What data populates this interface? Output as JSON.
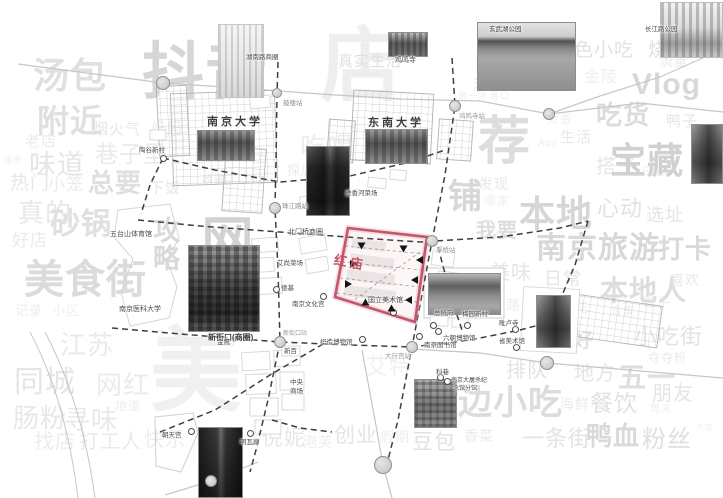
{
  "map": {
    "colors": {
      "zone": "#c4556a",
      "road": "#c6c6c6",
      "dashed": "#3f3f3f"
    },
    "zone": {
      "label": "红庙",
      "points": "348,228 427,237 415,322 335,297",
      "label_x": 334,
      "label_y": 252
    },
    "stations": [
      {
        "x": 163,
        "y": 83,
        "r": 7
      },
      {
        "x": 277,
        "y": 93,
        "r": 5
      },
      {
        "x": 455,
        "y": 106,
        "r": 6
      },
      {
        "x": 549,
        "y": 114,
        "r": 6
      },
      {
        "x": 275,
        "y": 208,
        "r": 6
      },
      {
        "x": 432,
        "y": 241,
        "r": 6
      },
      {
        "x": 280,
        "y": 342,
        "r": 6
      },
      {
        "x": 412,
        "y": 347,
        "r": 6
      },
      {
        "x": 547,
        "y": 363,
        "r": 7
      },
      {
        "x": 383,
        "y": 465,
        "r": 9
      },
      {
        "x": 211,
        "y": 481,
        "r": 6
      }
    ],
    "pois": [
      {
        "x": 163,
        "y": 158
      },
      {
        "x": 276,
        "y": 289
      },
      {
        "x": 323,
        "y": 296
      },
      {
        "x": 393,
        "y": 312
      },
      {
        "x": 433,
        "y": 325
      },
      {
        "x": 467,
        "y": 325
      },
      {
        "x": 515,
        "y": 329
      },
      {
        "x": 438,
        "y": 331
      },
      {
        "x": 419,
        "y": 336
      },
      {
        "x": 362,
        "y": 339
      },
      {
        "x": 516,
        "y": 347
      },
      {
        "x": 440,
        "y": 377
      },
      {
        "x": 447,
        "y": 381
      },
      {
        "x": 191,
        "y": 431
      },
      {
        "x": 250,
        "y": 433
      }
    ],
    "arrows": [
      {
        "x": 362,
        "y": 246,
        "a": 90
      },
      {
        "x": 404,
        "y": 249,
        "a": 90
      },
      {
        "x": 354,
        "y": 264,
        "a": 0
      },
      {
        "x": 349,
        "y": 284,
        "a": 0
      },
      {
        "x": 420,
        "y": 260,
        "a": 180
      },
      {
        "x": 415,
        "y": 280,
        "a": 180
      },
      {
        "x": 409,
        "y": 300,
        "a": 180
      },
      {
        "x": 366,
        "y": 302,
        "a": 270
      },
      {
        "x": 392,
        "y": 308,
        "a": 270
      }
    ],
    "photos": [
      {
        "x": 218,
        "y": 24,
        "w": 46,
        "h": 74,
        "v": "sketch",
        "name": "zifeng-tower-sketch"
      },
      {
        "x": 388,
        "y": 32,
        "w": 40,
        "h": 25,
        "v": "temple",
        "name": "jiming-temple-photo"
      },
      {
        "x": 477,
        "y": 22,
        "w": 99,
        "h": 69,
        "v": "lake",
        "name": "xuanwu-lake-photo"
      },
      {
        "x": 660,
        "y": 2,
        "w": 63,
        "h": 56,
        "v": "sketchcity",
        "name": "park-skyline-sketch"
      },
      {
        "x": 197,
        "y": 130,
        "w": 58,
        "h": 31,
        "v": "campus",
        "name": "nanjing-university-photo"
      },
      {
        "x": 365,
        "y": 129,
        "w": 63,
        "h": 35,
        "v": "campus",
        "name": "southeast-university-photo"
      },
      {
        "x": 306,
        "y": 146,
        "w": 44,
        "h": 70,
        "v": "tower",
        "name": "skyscraper-photo"
      },
      {
        "x": 188,
        "y": 245,
        "w": 72,
        "h": 87,
        "v": "city",
        "name": "xinjiekou-photo"
      },
      {
        "x": 428,
        "y": 273,
        "w": 73,
        "h": 42,
        "v": "gate",
        "name": "presidential-palace-photo"
      },
      {
        "x": 536,
        "y": 295,
        "w": 35,
        "h": 53,
        "v": "pagoda",
        "name": "pilu-temple-photo"
      },
      {
        "x": 414,
        "y": 379,
        "w": 43,
        "h": 49,
        "v": "building",
        "name": "kexiang-photo"
      },
      {
        "x": 198,
        "y": 427,
        "w": 45,
        "h": 71,
        "v": "street",
        "name": "old-street-photo"
      },
      {
        "x": 691,
        "y": 124,
        "w": 32,
        "h": 60,
        "v": "pagoda",
        "name": "east-temple-photo"
      }
    ],
    "labels": [
      {
        "t": "湖南路商圈",
        "x": 246,
        "y": 54,
        "s": 6.5
      },
      {
        "t": "鼓楼站",
        "x": 283,
        "y": 100,
        "s": 6.5,
        "c": "#8f8f8f"
      },
      {
        "t": "玄武湖公园",
        "x": 489,
        "y": 26,
        "s": 6.5,
        "c": "#3f3f3f"
      },
      {
        "t": "长江路公园",
        "x": 645,
        "y": 26,
        "s": 6.5
      },
      {
        "t": "鸡鸣寺",
        "x": 395,
        "y": 57,
        "s": 7
      },
      {
        "t": "鸡鸣寺站",
        "x": 459,
        "y": 113,
        "s": 6.5,
        "c": "#9a9a9a"
      },
      {
        "t": "南京大学",
        "x": 207,
        "y": 116,
        "s": 11,
        "b": 1,
        "ls": 3,
        "c": "#3c3c3c"
      },
      {
        "t": "东南大学",
        "x": 368,
        "y": 117,
        "s": 11,
        "b": 1,
        "ls": 3,
        "c": "#3c3c3c"
      },
      {
        "t": "陶谷新村",
        "x": 139,
        "y": 147,
        "s": 6.5
      },
      {
        "t": "珠江路站",
        "x": 282,
        "y": 203,
        "s": 6.5,
        "c": "#8f8f8f"
      },
      {
        "t": "进香河菜场",
        "x": 345,
        "y": 190,
        "s": 6.5
      },
      {
        "t": "北门桥商圈",
        "x": 288,
        "y": 229,
        "s": 7
      },
      {
        "t": "浮桥站",
        "x": 436,
        "y": 247,
        "s": 6.5,
        "c": "#9a9a9a"
      },
      {
        "t": "艾尚菜场",
        "x": 277,
        "y": 260,
        "s": 6.5
      },
      {
        "t": "德基",
        "x": 281,
        "y": 285,
        "s": 6.5
      },
      {
        "t": "南京文化宫",
        "x": 292,
        "y": 301,
        "s": 6.5
      },
      {
        "t": "国立美术馆",
        "x": 368,
        "y": 297,
        "s": 7
      },
      {
        "t": "五台山体育馆",
        "x": 110,
        "y": 231,
        "s": 7
      },
      {
        "t": "南京医科大学",
        "x": 119,
        "y": 306,
        "s": 7
      },
      {
        "t": "新街口(商圈)",
        "x": 208,
        "y": 333,
        "s": 8,
        "b": 1,
        "c": "#3c3c3c"
      },
      {
        "t": "新街口站",
        "x": 283,
        "y": 331,
        "s": 6,
        "c": "#9a9a9a"
      },
      {
        "t": "新百",
        "x": 284,
        "y": 348,
        "s": 6.5
      },
      {
        "t": "中央",
        "x": 290,
        "y": 379,
        "s": 6.5
      },
      {
        "t": "商场",
        "x": 290,
        "y": 388,
        "s": 6.5
      },
      {
        "t": "金鹰",
        "x": 217,
        "y": 339,
        "s": 6.5
      },
      {
        "t": "明瓦廊",
        "x": 240,
        "y": 439,
        "s": 6.5
      },
      {
        "t": "朝天宫",
        "x": 162,
        "y": 432,
        "s": 6.5
      },
      {
        "t": "织造博物馆",
        "x": 320,
        "y": 339,
        "s": 6.5
      },
      {
        "t": "大行宫站",
        "x": 385,
        "y": 353,
        "s": 6.5,
        "c": "#9a9a9a"
      },
      {
        "t": "南京图书馆",
        "x": 424,
        "y": 342,
        "s": 6.5
      },
      {
        "t": "六朝博物馆",
        "x": 443,
        "y": 335,
        "s": 6.5
      },
      {
        "t": "梅园新村",
        "x": 462,
        "y": 311,
        "s": 6.5
      },
      {
        "t": "总统府",
        "x": 434,
        "y": 310,
        "s": 6.5
      },
      {
        "t": "毗卢寺",
        "x": 499,
        "y": 320,
        "s": 6.5
      },
      {
        "t": "省美术馆",
        "x": 499,
        "y": 338,
        "s": 6.5
      },
      {
        "t": "科巷",
        "x": 436,
        "y": 369,
        "s": 6.5
      },
      {
        "t": "南京大屠杀纪",
        "x": 451,
        "y": 378,
        "s": 6
      },
      {
        "t": "念馆分馆",
        "x": 453,
        "y": 386,
        "s": 6
      }
    ],
    "wordcloud": [
      {
        "t": "汤包",
        "x": 33,
        "y": 58,
        "s": 36,
        "b": 1,
        "c": "#e0e0e0"
      },
      {
        "t": "抖音",
        "x": 142,
        "y": 42,
        "s": 62,
        "b": 1,
        "c": "#d6d6d6"
      },
      {
        "t": "店",
        "x": 320,
        "y": 26,
        "s": 82,
        "b": 1,
        "c": "#eeeeee"
      },
      {
        "t": "真实生活",
        "x": 338,
        "y": 54,
        "s": 15,
        "c": "#dfdfdf"
      },
      {
        "t": "吃喝",
        "x": 300,
        "y": 134,
        "s": 26,
        "c": "#ececec"
      },
      {
        "t": "探店",
        "x": 287,
        "y": 164,
        "s": 13,
        "c": "#ebebeb"
      },
      {
        "t": "收藏",
        "x": 202,
        "y": 175,
        "s": 11,
        "c": "#e9e9e9"
      },
      {
        "t": "下饭",
        "x": 149,
        "y": 181,
        "s": 15,
        "c": "#e5e5e5"
      },
      {
        "t": "妈妈",
        "x": 151,
        "y": 121,
        "s": 15,
        "c": "#ededed"
      },
      {
        "t": "烟火气",
        "x": 93,
        "y": 122,
        "s": 15,
        "c": "#e7e7e7"
      },
      {
        "t": "附近",
        "x": 37,
        "y": 105,
        "s": 32,
        "b": 1,
        "c": "#e0e0e0"
      },
      {
        "t": "老店",
        "x": 25,
        "y": 134,
        "s": 15,
        "c": "#eaeaea"
      },
      {
        "t": "城市",
        "x": 3,
        "y": 156,
        "s": 9,
        "c": "#eeeeee"
      },
      {
        "t": "味道",
        "x": 29,
        "y": 152,
        "s": 27,
        "c": "#e5e5e5"
      },
      {
        "t": "巷子里",
        "x": 95,
        "y": 143,
        "s": 23,
        "c": "#eaeaea"
      },
      {
        "t": "热门",
        "x": 10,
        "y": 174,
        "s": 19,
        "c": "#e7e7e7"
      },
      {
        "t": "小笼",
        "x": 48,
        "y": 176,
        "s": 17,
        "c": "#ebebeb"
      },
      {
        "t": "总要",
        "x": 88,
        "y": 170,
        "s": 26,
        "b": 1,
        "c": "#dfdfdf"
      },
      {
        "t": "真的",
        "x": 18,
        "y": 200,
        "s": 26,
        "c": "#e8e8e8"
      },
      {
        "t": "砂锅",
        "x": 50,
        "y": 210,
        "s": 30,
        "b": 1,
        "c": "#e0e0e0"
      },
      {
        "t": "好店",
        "x": 12,
        "y": 232,
        "s": 17,
        "c": "#ebebeb"
      },
      {
        "t": "攻略",
        "x": 150,
        "y": 216,
        "s": 27,
        "b": 1,
        "c": "#d9d9d9",
        "v": 1
      },
      {
        "t": "美食街",
        "x": 24,
        "y": 260,
        "s": 40,
        "b": 1,
        "c": "#dbdbdb"
      },
      {
        "t": "记录",
        "x": 15,
        "y": 304,
        "s": 13,
        "c": "#ececec"
      },
      {
        "t": "小区",
        "x": 52,
        "y": 304,
        "s": 13,
        "c": "#efefef"
      },
      {
        "t": "网红",
        "x": 196,
        "y": 213,
        "s": 52,
        "b": 1,
        "c": "#d2d2d2",
        "v": 1
      },
      {
        "t": "美",
        "x": 150,
        "y": 326,
        "s": 92,
        "b": 1,
        "c": "#f0f0f0"
      },
      {
        "t": "江苏",
        "x": 60,
        "y": 332,
        "s": 26,
        "c": "#eaeaea"
      },
      {
        "t": "同城",
        "x": 14,
        "y": 368,
        "s": 30,
        "c": "#e5e5e5"
      },
      {
        "t": "网红",
        "x": 96,
        "y": 372,
        "s": 26,
        "c": "#ebebeb"
      },
      {
        "t": "地道",
        "x": 115,
        "y": 400,
        "s": 12,
        "c": "#eeeeee"
      },
      {
        "t": "肠粉",
        "x": 13,
        "y": 405,
        "s": 26,
        "c": "#e7e7e7"
      },
      {
        "t": "寻味",
        "x": 64,
        "y": 407,
        "s": 26,
        "c": "#e9e9e9"
      },
      {
        "t": "找店",
        "x": 34,
        "y": 432,
        "s": 20,
        "c": "#ececec"
      },
      {
        "t": "打工人",
        "x": 79,
        "y": 432,
        "s": 20,
        "c": "#eaeaea"
      },
      {
        "t": "快乐",
        "x": 144,
        "y": 430,
        "s": 20,
        "c": "#ececec"
      },
      {
        "t": "倪妮",
        "x": 262,
        "y": 428,
        "s": 21,
        "c": "#e6e6e6"
      },
      {
        "t": "泡芙",
        "x": 303,
        "y": 435,
        "s": 14,
        "c": "#ededed"
      },
      {
        "t": "创业",
        "x": 334,
        "y": 425,
        "s": 21,
        "c": "#e4e4e4"
      },
      {
        "t": "假期",
        "x": 380,
        "y": 430,
        "s": 14,
        "c": "#eeeeee"
      },
      {
        "t": "艾特",
        "x": 366,
        "y": 356,
        "s": 22,
        "c": "#efefef"
      },
      {
        "t": "豆包",
        "x": 412,
        "y": 432,
        "s": 21,
        "c": "#e2e2e2"
      },
      {
        "t": "香菜",
        "x": 464,
        "y": 429,
        "s": 14,
        "c": "#ebebeb"
      },
      {
        "t": "一条街",
        "x": 522,
        "y": 428,
        "s": 22,
        "c": "#e3e3e3"
      },
      {
        "t": "鸭血",
        "x": 586,
        "y": 423,
        "s": 26,
        "b": 1,
        "c": "#d9d9d9"
      },
      {
        "t": "粉丝",
        "x": 642,
        "y": 428,
        "s": 24,
        "c": "#dfdfdf"
      },
      {
        "t": "天堂",
        "x": 696,
        "y": 424,
        "s": 8,
        "c": "#f0f0f0"
      },
      {
        "t": "边小吃",
        "x": 458,
        "y": 386,
        "s": 34,
        "b": 1,
        "c": "#dcdcdc"
      },
      {
        "t": "海鲜",
        "x": 560,
        "y": 397,
        "s": 14,
        "c": "#ebebeb"
      },
      {
        "t": "餐饮",
        "x": 590,
        "y": 392,
        "s": 23,
        "c": "#e1e1e1"
      },
      {
        "t": "周末",
        "x": 650,
        "y": 405,
        "s": 10,
        "c": "#efefef"
      },
      {
        "t": "朋友",
        "x": 652,
        "y": 384,
        "s": 20,
        "c": "#e5e5e5"
      },
      {
        "t": "五一",
        "x": 618,
        "y": 364,
        "s": 28,
        "b": 1,
        "c": "#dedede"
      },
      {
        "t": "地方",
        "x": 574,
        "y": 364,
        "s": 20,
        "c": "#e4e4e4"
      },
      {
        "t": "排队",
        "x": 506,
        "y": 361,
        "s": 20,
        "c": "#e2e2e2"
      },
      {
        "t": "夺夺粉",
        "x": 648,
        "y": 352,
        "s": 12,
        "c": "#eaeaea"
      },
      {
        "t": "小吃街",
        "x": 634,
        "y": 326,
        "s": 22,
        "c": "#e3e3e3"
      },
      {
        "t": "美好",
        "x": 552,
        "y": 331,
        "s": 20,
        "b": 1,
        "c": "#e1e1e1"
      },
      {
        "t": "合集",
        "x": 611,
        "y": 306,
        "s": 11,
        "c": "#eeeeee"
      },
      {
        "t": "桂花",
        "x": 561,
        "y": 301,
        "s": 13,
        "c": "#efefef"
      },
      {
        "t": "路边",
        "x": 506,
        "y": 298,
        "s": 14,
        "c": "#eeeeee"
      },
      {
        "t": "粽子",
        "x": 643,
        "y": 296,
        "s": 13,
        "c": "#ececec"
      },
      {
        "t": "本地人",
        "x": 600,
        "y": 277,
        "s": 28,
        "b": 1,
        "c": "#dddddd"
      },
      {
        "t": "喜欢",
        "x": 670,
        "y": 273,
        "s": 14,
        "c": "#e8e8e8"
      },
      {
        "t": "日常",
        "x": 544,
        "y": 270,
        "s": 18,
        "c": "#e6e6e6"
      },
      {
        "t": "美味",
        "x": 490,
        "y": 263,
        "s": 20,
        "c": "#e5e5e5"
      },
      {
        "t": "我要",
        "x": 476,
        "y": 221,
        "s": 20,
        "b": 1,
        "c": "#dddddd"
      },
      {
        "t": "南京旅游",
        "x": 536,
        "y": 234,
        "s": 30,
        "b": 1,
        "c": "#d8d8d8"
      },
      {
        "t": "打卡",
        "x": 658,
        "y": 236,
        "s": 26,
        "b": 1,
        "c": "#dadada"
      },
      {
        "t": "本地",
        "x": 519,
        "y": 196,
        "s": 36,
        "b": 1,
        "c": "#d6d6d6"
      },
      {
        "t": "心动",
        "x": 597,
        "y": 198,
        "s": 22,
        "c": "#e2e2e2"
      },
      {
        "t": "选址",
        "x": 646,
        "y": 206,
        "s": 18,
        "c": "#e5e5e5"
      },
      {
        "t": "哪家",
        "x": 484,
        "y": 195,
        "s": 12,
        "c": "#efefef"
      },
      {
        "t": "发现",
        "x": 479,
        "y": 177,
        "s": 14,
        "c": "#e8e8e8"
      },
      {
        "t": "铺",
        "x": 448,
        "y": 180,
        "s": 34,
        "b": 1,
        "c": "#d7d7d7"
      },
      {
        "t": "荐",
        "x": 478,
        "y": 116,
        "s": 52,
        "b": 1,
        "c": "#dddddd"
      },
      {
        "t": "搭子",
        "x": 596,
        "y": 157,
        "s": 20,
        "c": "#e7e7e7"
      },
      {
        "t": "日记",
        "x": 641,
        "y": 167,
        "s": 11,
        "c": "#efefef"
      },
      {
        "t": "宝藏",
        "x": 610,
        "y": 143,
        "s": 36,
        "b": 1,
        "c": "#d1d1d1"
      },
      {
        "t": "生活",
        "x": 560,
        "y": 130,
        "s": 15,
        "c": "#e8e8e8"
      },
      {
        "t": "App",
        "x": 538,
        "y": 139,
        "s": 10,
        "c": "#eeeeee"
      },
      {
        "t": "太香",
        "x": 547,
        "y": 113,
        "s": 12,
        "c": "#efefef"
      },
      {
        "t": "第一次",
        "x": 458,
        "y": 92,
        "s": 9,
        "c": "#eeeeee"
      },
      {
        "t": "胃口",
        "x": 490,
        "y": 92,
        "s": 9,
        "c": "#eeeeee"
      },
      {
        "t": "吃货",
        "x": 596,
        "y": 102,
        "s": 26,
        "b": 1,
        "c": "#dcdcdc"
      },
      {
        "t": "鸭子",
        "x": 666,
        "y": 114,
        "s": 15,
        "c": "#e6e6e6"
      },
      {
        "t": "Vlog",
        "x": 632,
        "y": 70,
        "s": 30,
        "b": 1,
        "c": "#d8d8d8"
      },
      {
        "t": "金陵",
        "x": 584,
        "y": 70,
        "s": 16,
        "c": "#efefef"
      },
      {
        "t": "流量",
        "x": 660,
        "y": 55,
        "s": 13,
        "c": "#eaeaea"
      },
      {
        "t": "特色小吃",
        "x": 554,
        "y": 41,
        "s": 19,
        "c": "#e2e2e2"
      },
      {
        "t": "烧饼",
        "x": 648,
        "y": 41,
        "s": 19,
        "c": "#dedede"
      },
      {
        "t": "油炸",
        "x": 473,
        "y": 78,
        "s": 13,
        "c": "#e6e6e6"
      }
    ]
  }
}
